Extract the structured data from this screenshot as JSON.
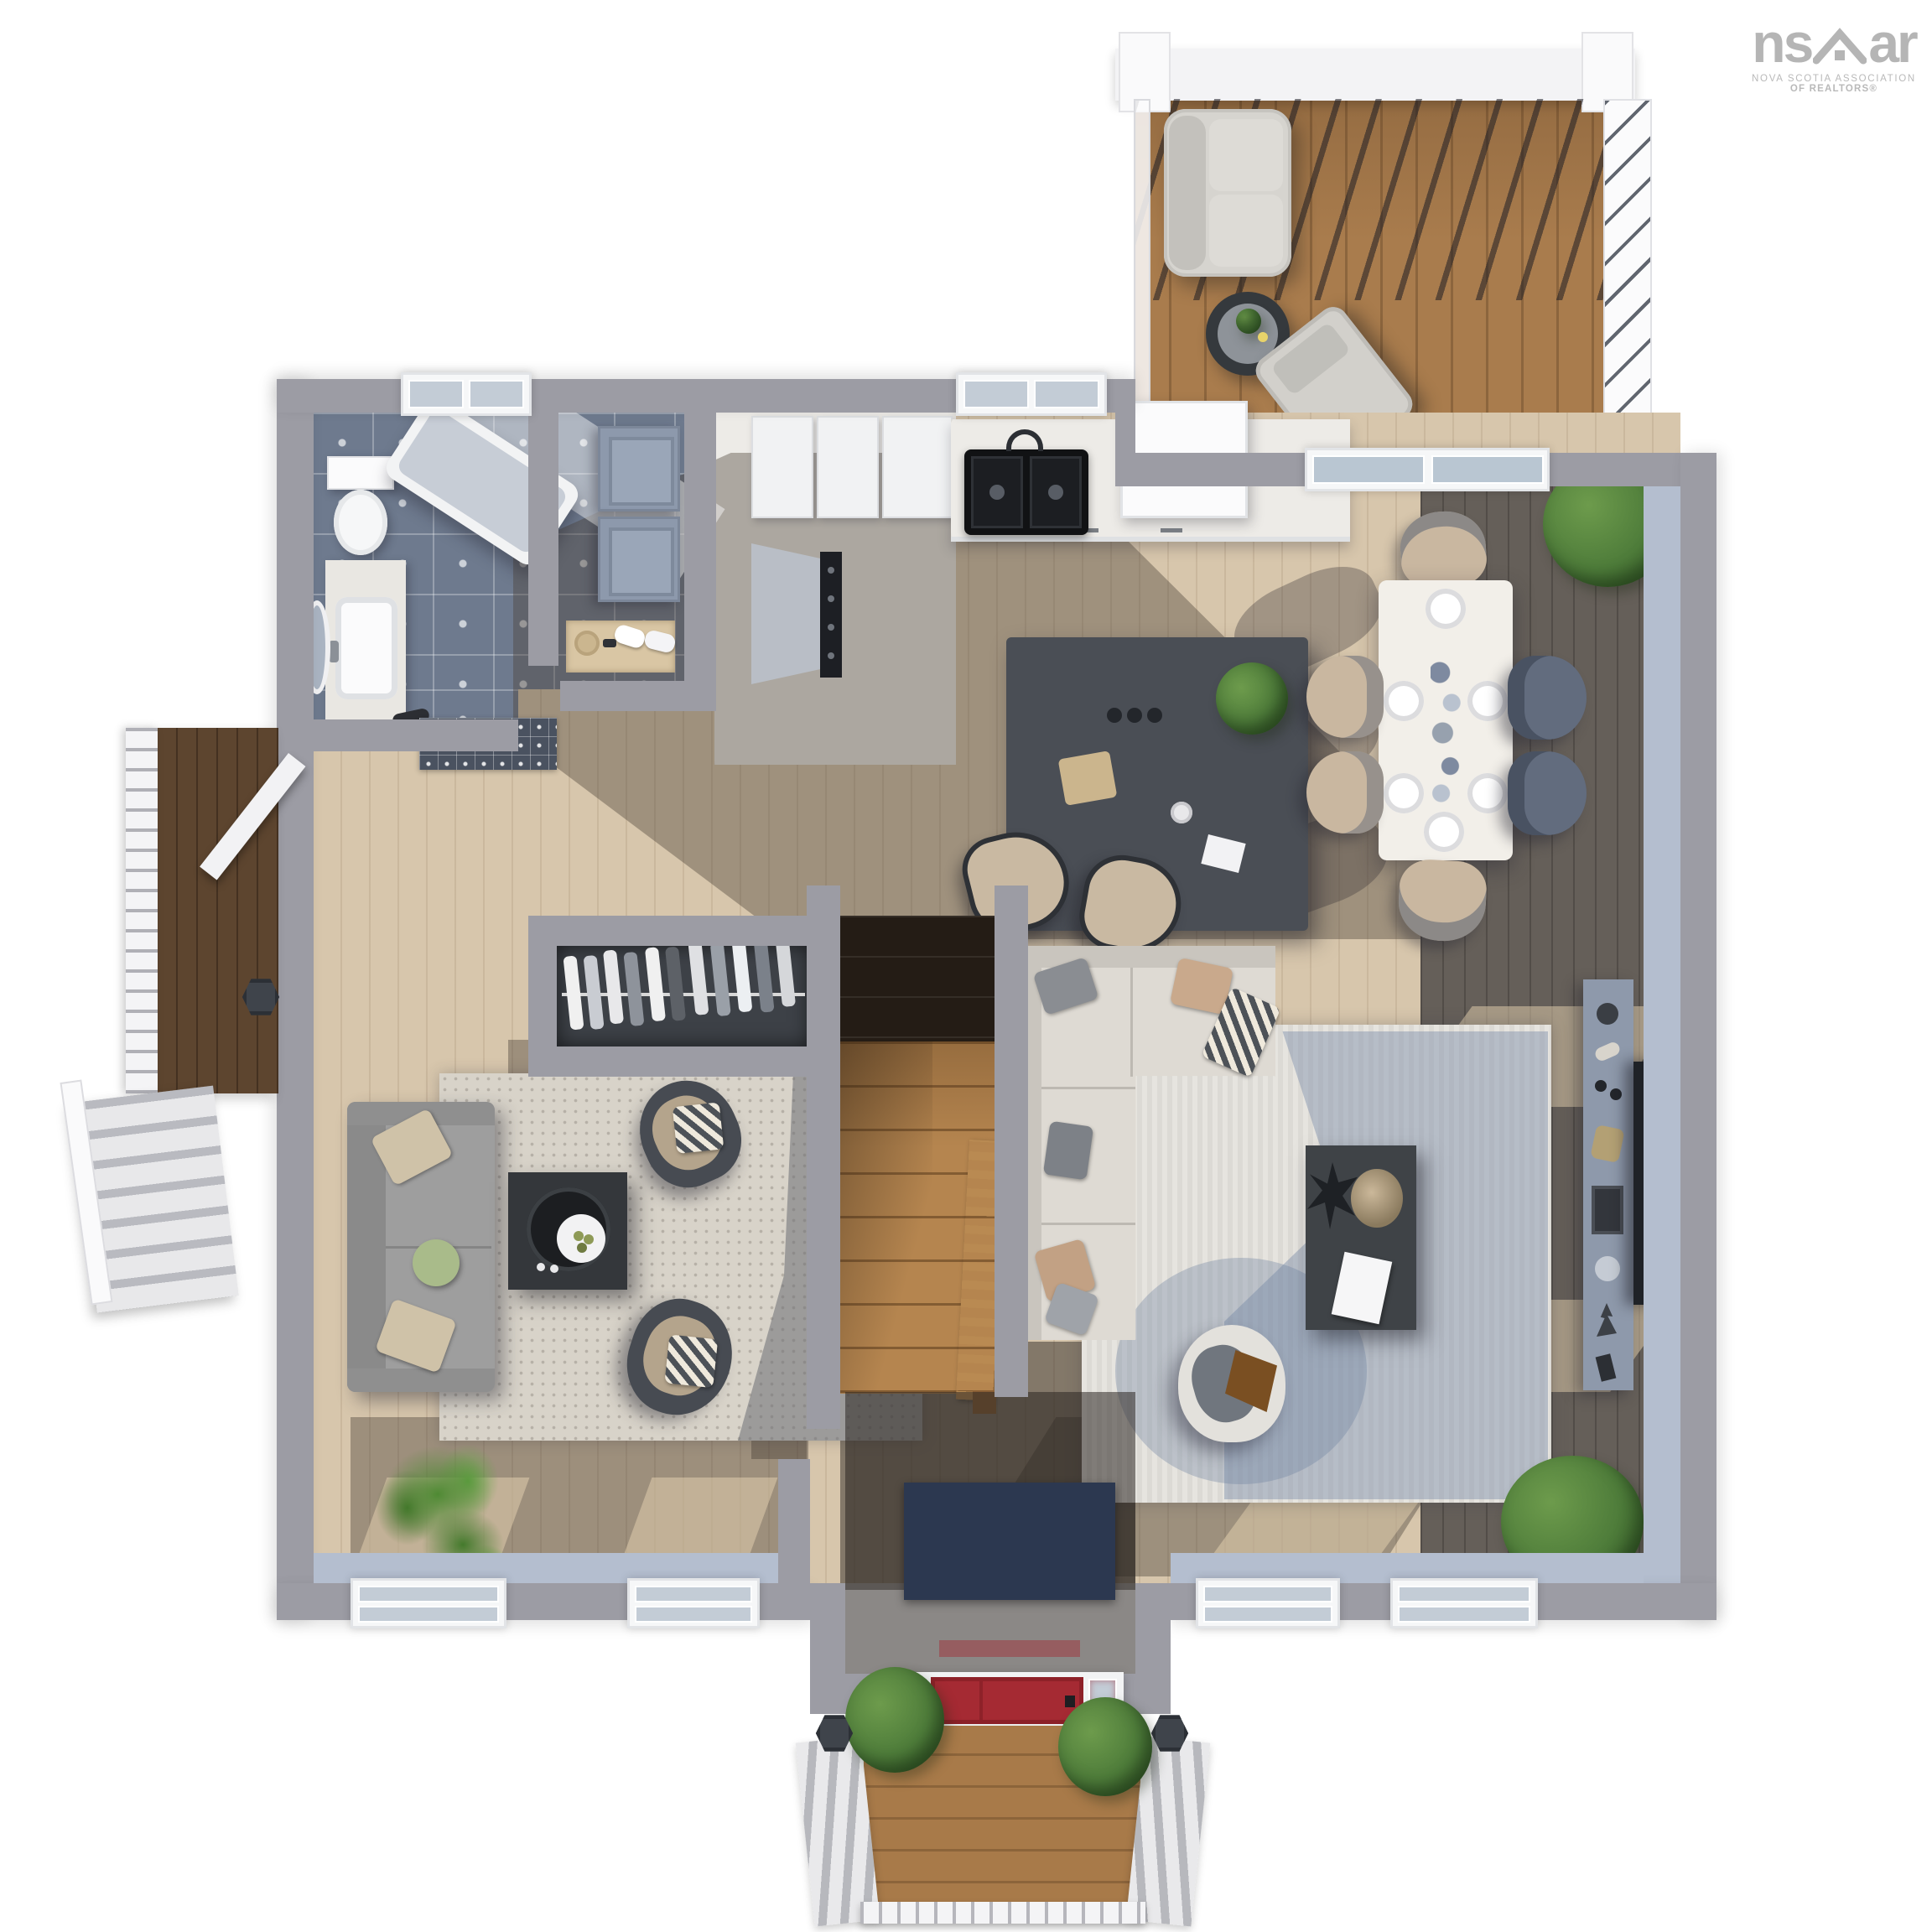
{
  "watermark": {
    "brand_left": "ns",
    "brand_right": "ar",
    "sub_line1": "NOVA SCOTIA ASSOCIATION",
    "sub_line2": "OF REALTORS®"
  },
  "palette": {
    "background": "#ffffff",
    "exterior_wall": "#9c9ca4",
    "interior_wall_face": "#b4becf",
    "hardwood_light": "#d7c6ac",
    "hardwood_shadowed": "#655f59",
    "rear_deck_wood": "#a97c4d",
    "side_deck_wood": "#5d452f",
    "bathroom_tile": "#6e7a8e",
    "kitchen_marble": "#edebe7",
    "kitchen_island": "#4a4e55",
    "front_door_red": "#a52a33",
    "living_rug": "#d8d3c9",
    "family_rug": "#e6e4df",
    "sofa_gray": "#9e9e9e",
    "sectional_cream": "#dedad3",
    "dining_chair_beige": "#c9b7a0",
    "dining_chair_slate": "#626c7e",
    "plant_green": "#4e7c3a",
    "entry_mat_navy": "#2c3850",
    "logo_gray": "#b5b5b5"
  },
  "scene": {
    "type": "3d-top-down-floor-plan-render",
    "level": "main floor",
    "rooms": [
      {
        "name": "bathroom",
        "floor": "patterned tile",
        "furniture": [
          "toilet",
          "vanity-sink",
          "oval-mirror",
          "bathtub",
          "window"
        ]
      },
      {
        "name": "laundry-room",
        "floor": "patterned tile",
        "furniture": [
          "washer",
          "dryer",
          "linen-niche-with-towels"
        ]
      },
      {
        "name": "pantry-corridor",
        "floor": "marble",
        "furniture": [
          "upper-cabinets",
          "range-with-hood"
        ]
      },
      {
        "name": "kitchen",
        "floor": "light hardwood",
        "furniture": [
          "double-basin-sink",
          "window",
          "refrigerator",
          "counter-cabinets",
          "island",
          "bar-stool",
          "bar-stool"
        ]
      },
      {
        "name": "dining-area",
        "floor": "light and dark hardwood",
        "furniture": [
          "dining-table-set-for-six",
          "dining-chair x6",
          "corner-plant"
        ]
      },
      {
        "name": "family-room",
        "floor": "hardwood with rug",
        "furniture": [
          "sectional-sofa",
          "ribbed-area-rug",
          "coffee-table",
          "swivel-armchair",
          "media-console",
          "tv-panel",
          "corner-plant"
        ]
      },
      {
        "name": "living-room",
        "floor": "hardwood with rug",
        "furniture": [
          "sofa",
          "speckled-area-rug",
          "coffee-table",
          "armchair x2",
          "palm-plant",
          "window x2"
        ]
      },
      {
        "name": "hallway",
        "floor": "light hardwood",
        "furniture": [
          "decorative-mat",
          "coat-closet-with-hangers"
        ]
      },
      {
        "name": "staircase",
        "furniture": [
          "dark-lower-flight",
          "wood-upper-flight",
          "wood-railing"
        ]
      },
      {
        "name": "entry-vestibule",
        "furniture": [
          "navy-door-mat",
          "red-front-door-with-sidelights"
        ]
      },
      {
        "name": "front-porch",
        "furniture": [
          "wood-deck",
          "railing",
          "lantern-post x2",
          "shrub x2",
          "side-steps"
        ]
      },
      {
        "name": "side-deck",
        "furniture": [
          "wood-landing",
          "white-railing",
          "stairs",
          "lantern-post",
          "side-entry-door"
        ]
      },
      {
        "name": "rear-deck",
        "furniture": [
          "pergola-slats",
          "cable-railing",
          "outdoor-loveseat",
          "round-side-table",
          "outdoor-lounge-chair",
          "lantern-cap x2"
        ]
      }
    ],
    "window_count": 7,
    "exterior_doors": [
      "red-front-door",
      "side-entry-door",
      "rear-sliding-glass-door"
    ]
  }
}
